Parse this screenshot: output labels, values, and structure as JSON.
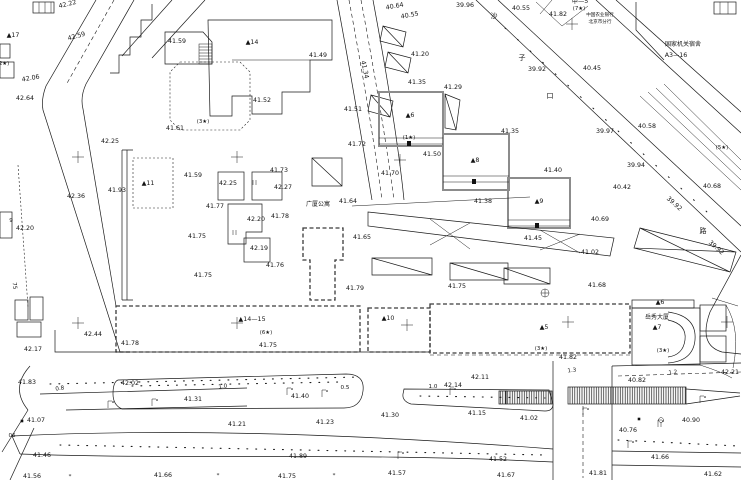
{
  "meta": {
    "drawing_type": "cadastral-survey-site-plan",
    "canvas": {
      "width": 741,
      "height": 480
    },
    "colors": {
      "background": "#ffffff",
      "ink": "#1a1a1a",
      "gray_building": "#8c8c8c"
    }
  },
  "labels": {
    "elevations": [
      [
        68,
        6,
        "42.22",
        -14
      ],
      [
        77,
        38,
        "42.59",
        -16
      ],
      [
        177,
        43,
        "41.59",
        0
      ],
      [
        31,
        80,
        "42.06",
        -10
      ],
      [
        25,
        100,
        "42.64",
        0
      ],
      [
        175,
        130,
        "41.61",
        0
      ],
      [
        110,
        143,
        "42.25",
        0
      ],
      [
        262,
        102,
        "41.52",
        0
      ],
      [
        318,
        57,
        "41.49",
        0
      ],
      [
        395,
        8,
        "40.64",
        -10
      ],
      [
        410,
        17,
        "40.55",
        -10
      ],
      [
        465,
        7,
        "39.96",
        0
      ],
      [
        521,
        10,
        "40.55",
        0
      ],
      [
        558,
        16,
        "41.82",
        0
      ],
      [
        537,
        71,
        "39.92",
        0
      ],
      [
        592,
        70,
        "40.45",
        0
      ],
      [
        605,
        133,
        "39.97",
        0
      ],
      [
        647,
        128,
        "40.58",
        0
      ],
      [
        636,
        167,
        "39.94",
        0
      ],
      [
        622,
        189,
        "40.42",
        0
      ],
      [
        712,
        188,
        "40.68",
        0
      ],
      [
        600,
        221,
        "40.69",
        0
      ],
      [
        673,
        205,
        "39.92",
        42
      ],
      [
        715,
        249,
        "39.92",
        42
      ],
      [
        417,
        84,
        "41.35",
        0
      ],
      [
        453,
        89,
        "41.29",
        0
      ],
      [
        420,
        56,
        "41.20",
        0
      ],
      [
        363,
        70,
        "41.34",
        78
      ],
      [
        353,
        111,
        "41.51",
        0
      ],
      [
        357,
        146,
        "41.72",
        0
      ],
      [
        390,
        175,
        "41.70",
        0
      ],
      [
        432,
        156,
        "41.50",
        0
      ],
      [
        510,
        133,
        "41.35",
        0
      ],
      [
        553,
        172,
        "41.40",
        0
      ],
      [
        533,
        240,
        "41.45",
        0
      ],
      [
        590,
        254,
        "41.02",
        0
      ],
      [
        597,
        287,
        "41.68",
        0
      ],
      [
        348,
        203,
        "41.64",
        0
      ],
      [
        362,
        239,
        "41.65",
        0
      ],
      [
        483,
        203,
        "41.38",
        0
      ],
      [
        457,
        288,
        "41.75",
        0
      ],
      [
        355,
        290,
        "41.79",
        0
      ],
      [
        117,
        192,
        "41.93",
        0
      ],
      [
        76,
        198,
        "42.36",
        0
      ],
      [
        25,
        230,
        "42.20",
        0
      ],
      [
        193,
        177,
        "41.59",
        0
      ],
      [
        228,
        185,
        "42.25",
        0
      ],
      [
        283,
        189,
        "42.27",
        0
      ],
      [
        279,
        172,
        "41.73",
        0
      ],
      [
        215,
        208,
        "41.77",
        0
      ],
      [
        280,
        218,
        "41.78",
        0
      ],
      [
        256,
        221,
        "42.20",
        0
      ],
      [
        197,
        238,
        "41.75",
        0
      ],
      [
        259,
        250,
        "42.19",
        0
      ],
      [
        275,
        267,
        "41.76",
        0
      ],
      [
        203,
        277,
        "41.75",
        0
      ],
      [
        130,
        345,
        "41.78",
        0
      ],
      [
        268,
        347,
        "41.75",
        0
      ],
      [
        93,
        336,
        "42.44",
        0
      ],
      [
        33,
        351,
        "42.17",
        0
      ],
      [
        27,
        384,
        "41.83",
        0
      ],
      [
        130,
        385,
        "42.02",
        0
      ],
      [
        193,
        401,
        "41.31",
        0
      ],
      [
        300,
        398,
        "41.40",
        0
      ],
      [
        453,
        387,
        "42.14",
        0
      ],
      [
        480,
        379,
        "42.11",
        0
      ],
      [
        568,
        359,
        "41.82",
        0
      ],
      [
        637,
        382,
        "40.82",
        0
      ],
      [
        730,
        374,
        "42.21",
        0
      ],
      [
        36,
        422,
        "41.07",
        0
      ],
      [
        237,
        426,
        "41.21",
        0
      ],
      [
        325,
        424,
        "41.23",
        0
      ],
      [
        390,
        417,
        "41.30",
        0
      ],
      [
        477,
        415,
        "41.15",
        0
      ],
      [
        529,
        420,
        "41.02",
        0
      ],
      [
        628,
        432,
        "40.76",
        0
      ],
      [
        691,
        422,
        "40.90",
        0
      ],
      [
        42,
        457,
        "41.46",
        0
      ],
      [
        298,
        458,
        "41.89",
        0
      ],
      [
        498,
        461,
        "41.52",
        0
      ],
      [
        660,
        459,
        "41.66",
        0
      ],
      [
        32,
        478,
        "41.56",
        0
      ],
      [
        163,
        477,
        "41.66",
        0
      ],
      [
        287,
        478,
        "41.75",
        0
      ],
      [
        397,
        475,
        "41.57",
        0
      ],
      [
        506,
        477,
        "41.67",
        0
      ],
      [
        598,
        475,
        "41.81",
        0
      ],
      [
        713,
        476,
        "41.62",
        0
      ]
    ],
    "building_codes": [
      [
        13,
        37,
        "▲17"
      ],
      [
        252,
        44,
        "▲14"
      ],
      [
        148,
        185,
        "▲11"
      ],
      [
        410,
        117,
        "▲6"
      ],
      [
        475,
        162,
        "▲8"
      ],
      [
        539,
        203,
        "▲9"
      ],
      [
        388,
        320,
        "▲10"
      ],
      [
        252,
        321,
        "▲14—15"
      ],
      [
        544,
        329,
        "▲5"
      ],
      [
        660,
        304,
        "▲6"
      ],
      [
        657,
        329,
        "▲7"
      ],
      [
        580,
        3,
        "甲—5"
      ],
      [
        676,
        57,
        "A3—16"
      ]
    ],
    "story_notes": [
      [
        3,
        65,
        "(2★)"
      ],
      [
        203,
        123,
        "(3★)"
      ],
      [
        409,
        139,
        "(1★)"
      ],
      [
        579,
        10,
        "(7★)"
      ],
      [
        722,
        149,
        "(5★)"
      ],
      [
        266,
        334,
        "(6★)"
      ],
      [
        541,
        350,
        "(3★)"
      ],
      [
        663,
        352,
        "(3★)"
      ]
    ],
    "names": [
      [
        318,
        206,
        "广厦公寓",
        "name"
      ],
      [
        657,
        319,
        "岳秀大厦",
        "name"
      ],
      [
        600,
        16,
        "中国农业银行",
        "name5"
      ],
      [
        600,
        23,
        "北京市分行",
        "name5"
      ],
      [
        683,
        46,
        "国家机关宿舍",
        "name"
      ]
    ],
    "street_chars": [
      [
        494,
        18,
        "沙"
      ],
      [
        522,
        60,
        "子"
      ],
      [
        550,
        98,
        "口"
      ],
      [
        703,
        233,
        "路"
      ]
    ],
    "road_marks": [
      [
        60,
        390,
        "0.8",
        -8
      ],
      [
        223,
        388,
        "1.0",
        -8
      ],
      [
        345,
        389,
        "0.5",
        0
      ],
      [
        433,
        388,
        "1.0",
        0
      ],
      [
        572,
        372,
        "1.3",
        -6
      ],
      [
        673,
        374,
        "1.2",
        -6
      ],
      [
        13,
        286,
        "75",
        83
      ],
      [
        12,
        437,
        "06",
        0
      ],
      [
        11,
        222,
        "9",
        0
      ],
      [
        70,
        478,
        "*",
        0
      ],
      [
        334,
        477,
        "*",
        0
      ],
      [
        218,
        477,
        "*",
        0
      ]
    ]
  },
  "symbols": {
    "survey_crosses": [
      [
        78,
        157
      ],
      [
        237,
        157
      ],
      [
        400,
        160
      ],
      [
        78,
        323
      ],
      [
        237,
        323
      ],
      [
        407,
        325
      ],
      [
        568,
        322
      ],
      [
        727,
        322
      ],
      [
        572,
        24
      ]
    ],
    "street_lamps": [
      [
        108,
        401
      ],
      [
        152,
        399
      ],
      [
        287,
        388
      ],
      [
        322,
        390
      ],
      [
        450,
        388
      ],
      [
        398,
        452
      ],
      [
        628,
        441
      ],
      [
        700,
        396
      ],
      [
        658,
        420
      ],
      [
        583,
        408
      ]
    ],
    "point_squares": [
      [
        22,
        421
      ],
      [
        639,
        419
      ]
    ],
    "circle_cross_wells": [
      [
        545,
        293
      ]
    ],
    "circle_stem_marks": [
      [
        661,
        422
      ]
    ]
  }
}
